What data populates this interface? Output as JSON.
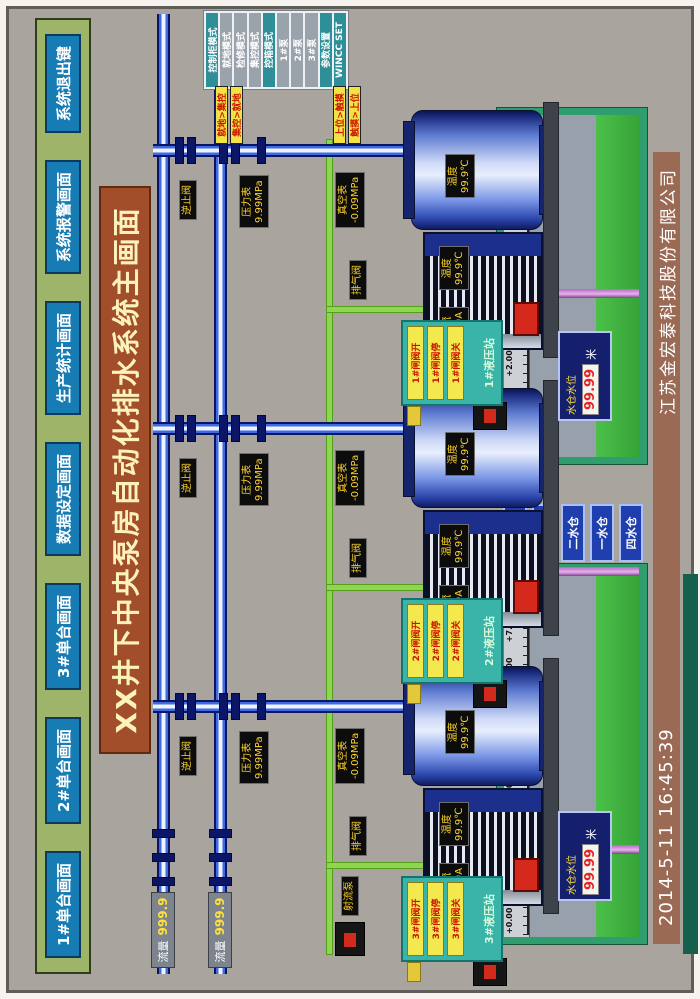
{
  "nav": {
    "buttons": [
      "1#单台画面",
      "2#单台画面",
      "3#单台画面",
      "数据设定画面",
      "生产统计画面",
      "系统报警画面",
      "系统退出键"
    ]
  },
  "title": "XX井下中央泵房自动化排水系统主画面",
  "mode_panel": {
    "rows": [
      {
        "label": "控制柜模式",
        "accent": true
      },
      {
        "label": "就地模式",
        "accent": false
      },
      {
        "label": "检修模式",
        "accent": false
      },
      {
        "label": "集控模式",
        "accent": false
      },
      {
        "label": "控箱模式",
        "accent": true
      },
      {
        "label": "1#泵",
        "accent": false
      },
      {
        "label": "2#泵",
        "accent": false
      },
      {
        "label": "3#泵",
        "accent": false
      },
      {
        "label": "参数设置",
        "accent": true
      },
      {
        "label": "WINCC SET",
        "accent": true
      }
    ]
  },
  "tags": [
    "就地>集控",
    "集控>就地",
    "上位>触摸",
    "触摸>上位"
  ],
  "mains": [
    {
      "flow_label": "流量",
      "flow_value": "999.9"
    },
    {
      "flow_label": "流量",
      "flow_value": "999.9"
    }
  ],
  "jet_pump_label": "射流泵",
  "labels": {
    "check_valve": "逆止阀",
    "pressure": "压力表",
    "pressure_value": "9.99MPa",
    "vacuum": "真空表",
    "vacuum_value": "-0.09MPa",
    "air_valve": "排气阀",
    "temp": "温度",
    "temp_value": "99.9℃",
    "current": "电流",
    "current_value": "99.9A"
  },
  "units": [
    {
      "panel_title": "3#液压站",
      "buttons": [
        "3#闸阀开",
        "3#闸阀停",
        "3#闸阀关"
      ]
    },
    {
      "panel_title": "2#液压站",
      "buttons": [
        "2#闸阀开",
        "2#闸阀停",
        "2#闸阀关"
      ]
    },
    {
      "panel_title": "1#液压站",
      "buttons": [
        "1#闸阀开",
        "1#闸阀停",
        "1#闸阀关"
      ]
    }
  ],
  "sumps": {
    "scale_labels": [
      "+0.00",
      "+1.00",
      "+2.00",
      "+3.00",
      "+4.00",
      "+5.00",
      "+6.00",
      "+7.00",
      "+8.00"
    ],
    "lcd_label": "水仓水位",
    "lcd_value": "99.99",
    "lcd_unit": "米"
  },
  "sump_buttons": [
    "回水仓",
    "三水仓",
    "二水仓",
    "一水仓",
    "四水仓"
  ],
  "footer": {
    "datetime": "2014-5-11  16:45:39",
    "company": "江苏金宏泰科技股份有限公司"
  }
}
